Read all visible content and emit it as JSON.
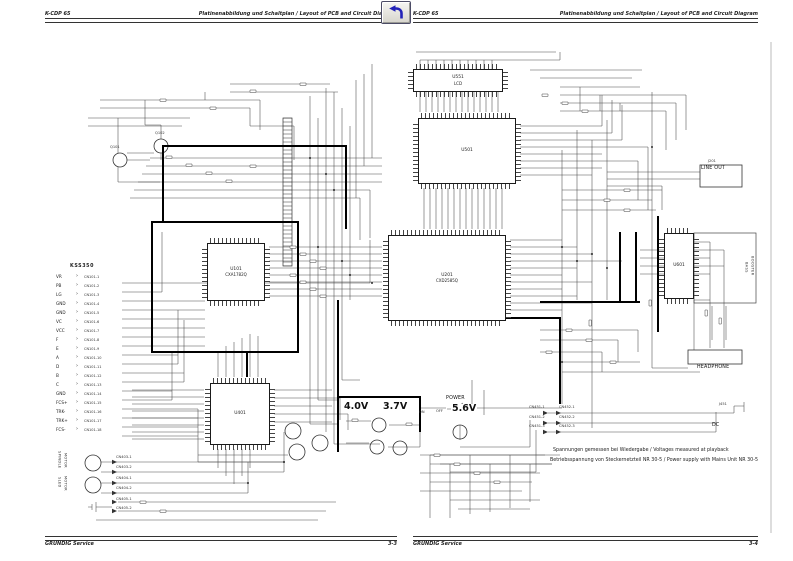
{
  "pages": {
    "left": {
      "model": "K-CDP 65",
      "title": "Platinenabbildung und Schaltplan / Layout of PCB and Circuit Diagram",
      "footer_brand": "GRUNDIG Service",
      "footer_page": "3-3"
    },
    "right": {
      "model": "K-CDP 65",
      "title": "Platinenabbildung und Schaltplan / Layout of PCB and Circuit Diagram",
      "footer_brand": "GRUNDIG Service",
      "footer_page": "3-4"
    }
  },
  "schematic": {
    "pickup": {
      "name": "KSS350",
      "arrow": "›",
      "pins": [
        {
          "n": "VR",
          "c": "CN101-1"
        },
        {
          "n": "PB",
          "c": "CN101-2"
        },
        {
          "n": "LG",
          "c": "CN101-3"
        },
        {
          "n": "GND",
          "c": "CN101-4"
        },
        {
          "n": "GND",
          "c": "CN101-5"
        },
        {
          "n": "VC",
          "c": "CN101-6"
        },
        {
          "n": "VCC",
          "c": "CN101-7"
        },
        {
          "n": "F",
          "c": "CN101-8"
        },
        {
          "n": "E",
          "c": "CN101-9"
        },
        {
          "n": "A",
          "c": "CN101-10"
        },
        {
          "n": "D",
          "c": "CN101-11"
        },
        {
          "n": "B",
          "c": "CN101-12"
        },
        {
          "n": "C",
          "c": "CN101-13"
        },
        {
          "n": "GND",
          "c": "CN101-14"
        },
        {
          "n": "FCS+",
          "c": "CN101-15"
        },
        {
          "n": "TRK-",
          "c": "CN101-16"
        },
        {
          "n": "TRK+",
          "c": "CN101-17"
        },
        {
          "n": "FCS-",
          "c": "CN101-18"
        }
      ]
    },
    "ics": [
      {
        "ref": "U551",
        "part": "LCD",
        "x": 413,
        "y": 69,
        "w": 88,
        "h": 21
      },
      {
        "ref": "U501",
        "part": "",
        "x": 418,
        "y": 118,
        "w": 96,
        "h": 64
      },
      {
        "ref": "U201",
        "part": "CXD2585Q",
        "x": 388,
        "y": 235,
        "w": 116,
        "h": 84
      },
      {
        "ref": "U101",
        "part": "CXA1782Q",
        "x": 207,
        "y": 243,
        "w": 56,
        "h": 56
      },
      {
        "ref": "U401",
        "part": "",
        "x": 210,
        "y": 383,
        "w": 58,
        "h": 60
      },
      {
        "ref": "U601",
        "part": "",
        "x": 664,
        "y": 233,
        "w": 28,
        "h": 64
      }
    ],
    "labels": [
      {
        "t": "J201",
        "x": 708,
        "y": 160,
        "cls": "tiny"
      },
      {
        "t": "LINE  OUT",
        "x": 701,
        "y": 167,
        "cls": "s5"
      },
      {
        "t": "HEADPHONE",
        "x": 697,
        "y": 366,
        "cls": "s5"
      },
      {
        "t": "BASS",
        "x": 744,
        "y": 262,
        "cls": "rot"
      },
      {
        "t": "BOOSTER",
        "x": 750,
        "y": 256,
        "cls": "rot"
      },
      {
        "t": "DC",
        "x": 712,
        "y": 424,
        "cls": "s5"
      },
      {
        "t": "J451",
        "x": 719,
        "y": 403,
        "cls": "tiny"
      },
      {
        "t": "POWER",
        "x": 446,
        "y": 397,
        "cls": "s5"
      },
      {
        "t": "ON",
        "x": 419,
        "y": 411,
        "cls": "tiny"
      },
      {
        "t": "OFF",
        "x": 436,
        "y": 410,
        "cls": "tiny"
      },
      {
        "t": "4.0V",
        "x": 343,
        "y": 402,
        "cls": "big"
      },
      {
        "t": "3.7V",
        "x": 382,
        "y": 402,
        "cls": "big"
      },
      {
        "t": "5.6V",
        "x": 451,
        "y": 404,
        "cls": "big"
      },
      {
        "t": "SPINDLE",
        "x": 57,
        "y": 451,
        "cls": "rot"
      },
      {
        "t": "MOTOR",
        "x": 63,
        "y": 453,
        "cls": "rot"
      },
      {
        "t": "SLED",
        "x": 57,
        "y": 477,
        "cls": "rot"
      },
      {
        "t": "MOTOR",
        "x": 63,
        "y": 476,
        "cls": "rot"
      },
      {
        "t": "CN403-1",
        "x": 116,
        "y": 456,
        "cls": "tiny"
      },
      {
        "t": "CN403-2",
        "x": 116,
        "y": 466,
        "cls": "tiny"
      },
      {
        "t": "CN404-1",
        "x": 116,
        "y": 477,
        "cls": "tiny"
      },
      {
        "t": "CN404-2",
        "x": 116,
        "y": 487,
        "cls": "tiny"
      },
      {
        "t": "CN405-1",
        "x": 116,
        "y": 498,
        "cls": "tiny"
      },
      {
        "t": "CN405-2",
        "x": 116,
        "y": 507,
        "cls": "tiny"
      },
      {
        "t": "CN451-1",
        "x": 529,
        "y": 406,
        "cls": "tiny"
      },
      {
        "t": "CN451-2",
        "x": 529,
        "y": 416,
        "cls": "tiny"
      },
      {
        "t": "CN451-3",
        "x": 529,
        "y": 425,
        "cls": "tiny"
      },
      {
        "t": "CN452-1",
        "x": 559,
        "y": 406,
        "cls": "tiny"
      },
      {
        "t": "CN452-2",
        "x": 559,
        "y": 416,
        "cls": "tiny"
      },
      {
        "t": "CN452-3",
        "x": 559,
        "y": 425,
        "cls": "tiny"
      },
      {
        "t": "Q101",
        "x": 110,
        "y": 146,
        "cls": "tiny"
      },
      {
        "t": "Q102",
        "x": 155,
        "y": 132,
        "cls": "tiny"
      }
    ],
    "notes": {
      "line1": "Spannungen gemessen bei Wiedergabe / Voltages measured at playback",
      "line2": "Betriebsspannung von Steckernetzteil NR 30-5 / Power supply with Mains Unit NR 30-5"
    }
  }
}
